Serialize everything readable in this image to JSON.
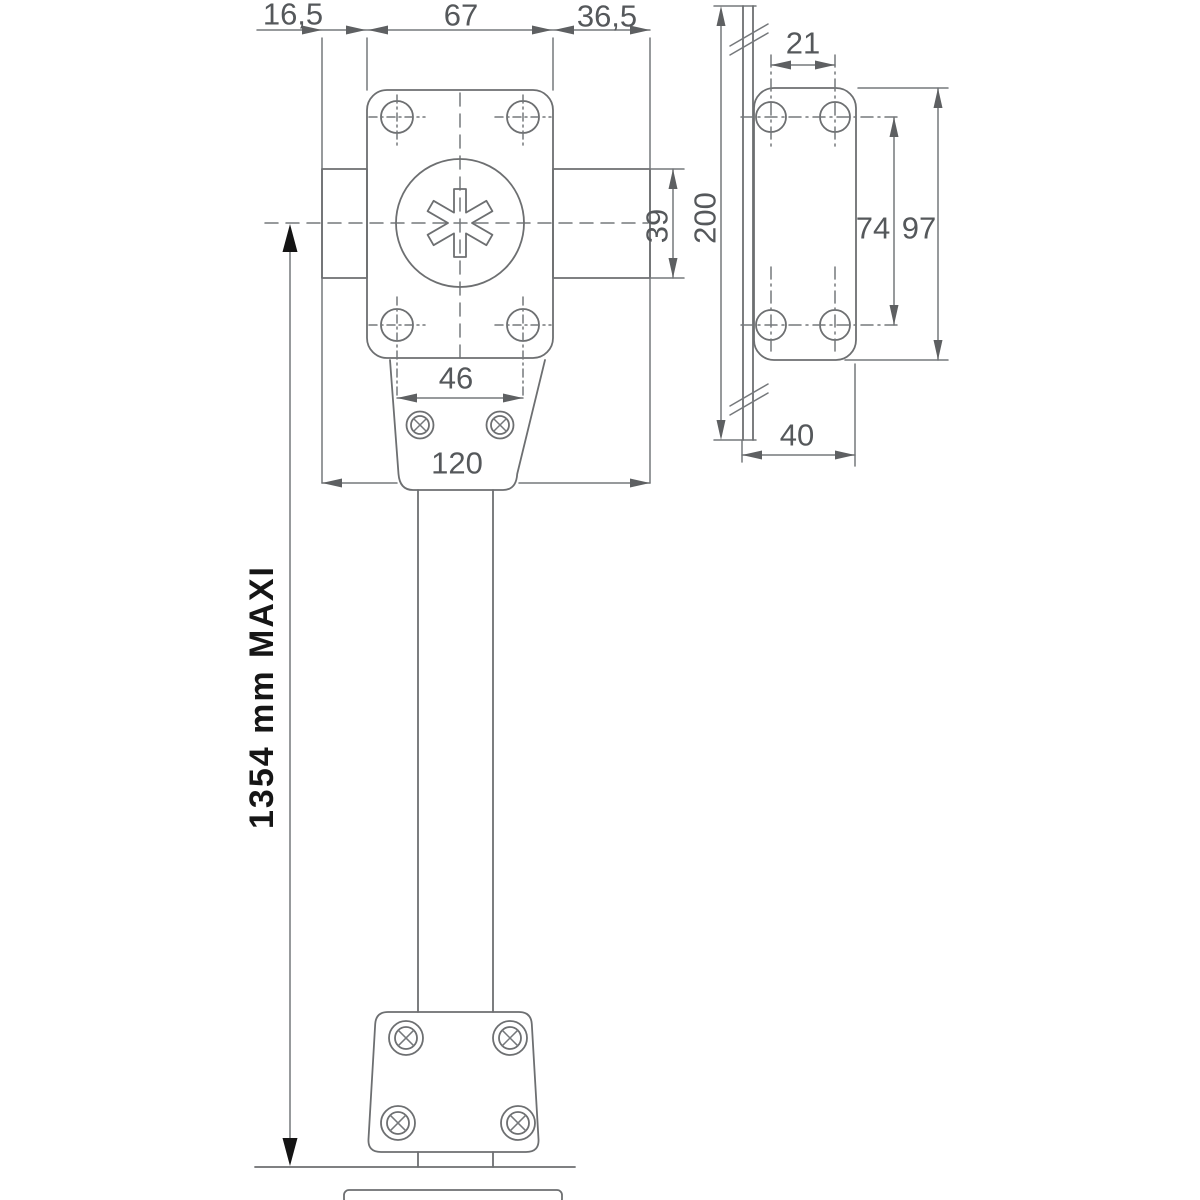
{
  "front_view": {
    "dims": {
      "offset_left": "16,5",
      "body_width": "67",
      "offset_right": "36,5",
      "bolt_height": "39",
      "screw_spacing": "46",
      "overall_width": "120",
      "max_extension": "1354 mm MAXI"
    }
  },
  "side_view": {
    "dims": {
      "hole_spacing_horizontal": "21",
      "rail_length": "200",
      "hole_spacing_vertical": "74",
      "plate_height": "97",
      "plate_depth": "40"
    }
  },
  "style": {
    "line_color": "#6d6f71",
    "dim_text_color": "#55585b",
    "emphasis_text_color": "#161616",
    "background": "#ffffff"
  }
}
